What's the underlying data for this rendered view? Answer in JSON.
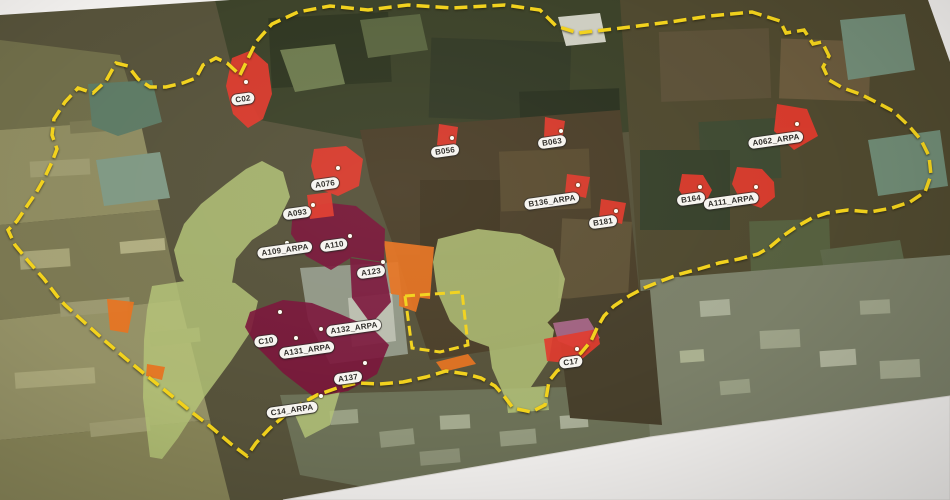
{
  "map": {
    "title": "printed-satellite-map-photo",
    "colors": {
      "boundary": "#f2d21c",
      "site-red": "#e13a2c",
      "zone-maroon": "#7a1339",
      "zone-orange": "#e8731f",
      "zone-green": "#b5c478",
      "zone-pink": "#bd6f9b",
      "paper": "#f2f0ee"
    },
    "sites": [
      {
        "label": "C02",
        "x": 243,
        "y": 99,
        "dot_x": 246,
        "dot_y": 82
      },
      {
        "label": "A076",
        "x": 325,
        "y": 184,
        "dot_x": 338,
        "dot_y": 168
      },
      {
        "label": "A093",
        "x": 297,
        "y": 213,
        "dot_x": 313,
        "dot_y": 205
      },
      {
        "label": "A109_ARPA",
        "x": 285,
        "y": 250,
        "dot_x": 287,
        "dot_y": 243
      },
      {
        "label": "A110",
        "x": 334,
        "y": 245,
        "dot_x": 350,
        "dot_y": 236
      },
      {
        "label": "A123",
        "x": 371,
        "y": 272,
        "dot_x": 383,
        "dot_y": 262
      },
      {
        "label": "C10",
        "x": 266,
        "y": 341,
        "dot_x": 280,
        "dot_y": 312
      },
      {
        "label": "A131_ARPA",
        "x": 307,
        "y": 350,
        "dot_x": 296,
        "dot_y": 338
      },
      {
        "label": "A132_ARPA",
        "x": 354,
        "y": 328,
        "dot_x": 321,
        "dot_y": 329
      },
      {
        "label": "A137",
        "x": 348,
        "y": 378,
        "dot_x": 365,
        "dot_y": 363
      },
      {
        "label": "C14_ARPA",
        "x": 292,
        "y": 410,
        "dot_x": 321,
        "dot_y": 396
      },
      {
        "label": "C17",
        "x": 571,
        "y": 362,
        "dot_x": 577,
        "dot_y": 349
      },
      {
        "label": "B056",
        "x": 445,
        "y": 151,
        "dot_x": 452,
        "dot_y": 138
      },
      {
        "label": "B063",
        "x": 552,
        "y": 142,
        "dot_x": 561,
        "dot_y": 131
      },
      {
        "label": "B136_ARPA",
        "x": 552,
        "y": 201,
        "dot_x": 578,
        "dot_y": 185
      },
      {
        "label": "B181",
        "x": 603,
        "y": 222,
        "dot_x": 616,
        "dot_y": 211
      },
      {
        "label": "B164",
        "x": 691,
        "y": 199,
        "dot_x": 700,
        "dot_y": 187
      },
      {
        "label": "A111_ARPA",
        "x": 731,
        "y": 201,
        "dot_x": 756,
        "dot_y": 187
      },
      {
        "label": "A062_ARPA",
        "x": 776,
        "y": 140,
        "dot_x": 797,
        "dot_y": 124
      }
    ]
  }
}
